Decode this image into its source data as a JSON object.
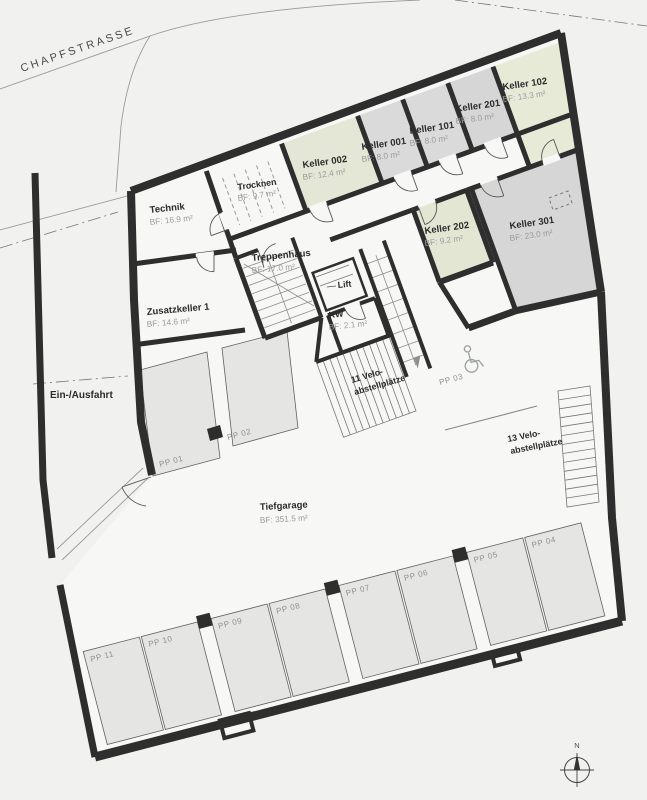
{
  "street": {
    "label": "CHAPFSTRASSE"
  },
  "entrance": {
    "label": "Ein-/Ausfahrt"
  },
  "north": {
    "label": "N"
  },
  "rooms": {
    "technik": {
      "name": "Technik",
      "area": "BF: 16.9 m²"
    },
    "trocknen": {
      "name": "Trocknen",
      "area": "BF: 9.7 m²"
    },
    "keller002": {
      "name": "Keller 002",
      "area": "BF: 12.4 m²"
    },
    "keller001": {
      "name": "Keller 001",
      "area": "BF: 8.0 m²"
    },
    "keller101": {
      "name": "Keller 101",
      "area": "BF: 8.0 m²"
    },
    "keller201": {
      "name": "Keller 201",
      "area": "BF: 8.0 m²"
    },
    "keller102": {
      "name": "Keller 102",
      "area": "BF: 13.3 m²"
    },
    "keller202": {
      "name": "Keller 202",
      "area": "BF: 9.2 m²"
    },
    "keller301": {
      "name": "Keller 301",
      "area": "BF: 23.0 m²"
    },
    "treppenhaus": {
      "name": "Treppenhaus",
      "area": "BF: 17.0 m²"
    },
    "lift": {
      "name": "Lift"
    },
    "kw": {
      "name": "KW",
      "area": "BF: 2.1 m²"
    },
    "zusatzkeller": {
      "name": "Zusatzkeller 1",
      "area": "BF: 14.6 m²"
    },
    "tiefgarage": {
      "name": "Tiefgarage",
      "area": "BF: 351.5 m²"
    }
  },
  "velo": {
    "left": {
      "line1": "11 Velo-",
      "line2": "abstellplätze"
    },
    "right": {
      "line1": "13 Velo-",
      "line2": "abstellplätze"
    }
  },
  "parking": {
    "pp01": "PP 01",
    "pp02": "PP 02",
    "pp03": "PP 03",
    "pp04": "PP 04",
    "pp05": "PP 05",
    "pp06": "PP 06",
    "pp07": "PP 07",
    "pp08": "PP 08",
    "pp09": "PP 09",
    "pp10": "PP 10",
    "pp11": "PP 11"
  },
  "colors": {
    "wall": "#2e2e2e",
    "room_green": "#e5e7d6",
    "room_gray": "#dadadb",
    "parking_fill": "#e5e5e4",
    "interior": "#f7f7f5",
    "text_muted": "#9b9b9b"
  }
}
